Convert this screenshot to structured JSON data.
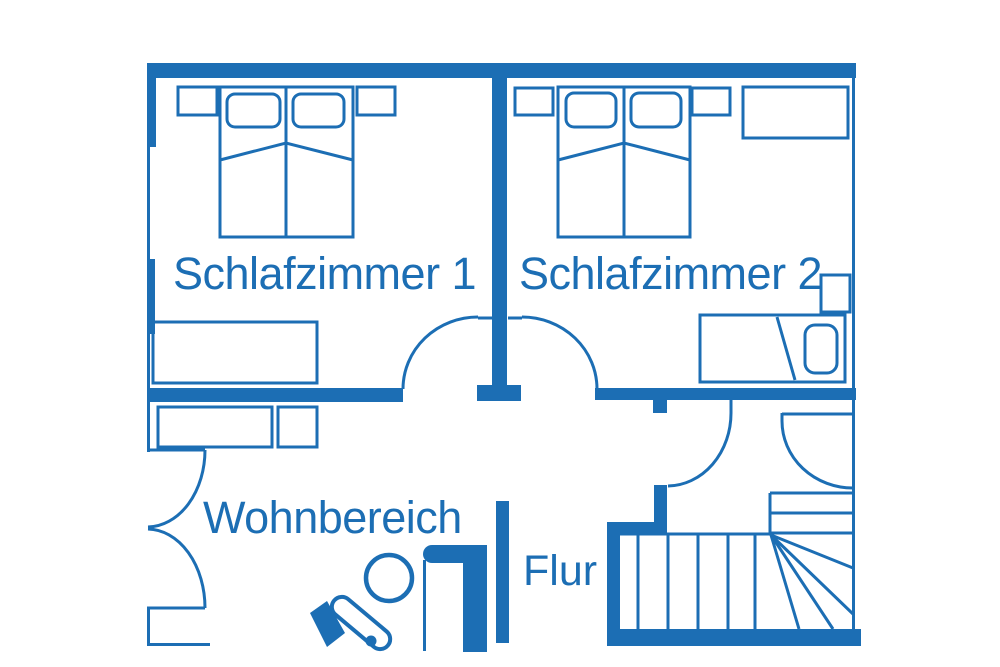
{
  "plan": {
    "background_color": "#ffffff",
    "line_color": "#1c6eb4",
    "rooms": [
      {
        "label": "Schlafzimmer 1"
      },
      {
        "label": "Schlafzimmer 2"
      },
      {
        "label": "Wohnbereich"
      },
      {
        "label": "Flur"
      }
    ],
    "features": {
      "schlafzimmer1": [
        "double-bed-icon",
        "pillow-icon",
        "nightstand-icon",
        "sideboard-icon",
        "door-swing-icon"
      ],
      "schlafzimmer2": [
        "double-bed-icon",
        "pillow-icon",
        "nightstand-icon",
        "wardrobe-icon",
        "single-bed-icon",
        "side-table-icon",
        "door-swing-icon"
      ],
      "wohnbereich": [
        "sideboard-icon",
        "cabinet-icon",
        "double-door-swing-icon",
        "person-reading-icon",
        "open-door-icon"
      ],
      "flur": [
        "staircase-icon",
        "winder-stairs-icon",
        "door-swing-icon"
      ]
    }
  }
}
